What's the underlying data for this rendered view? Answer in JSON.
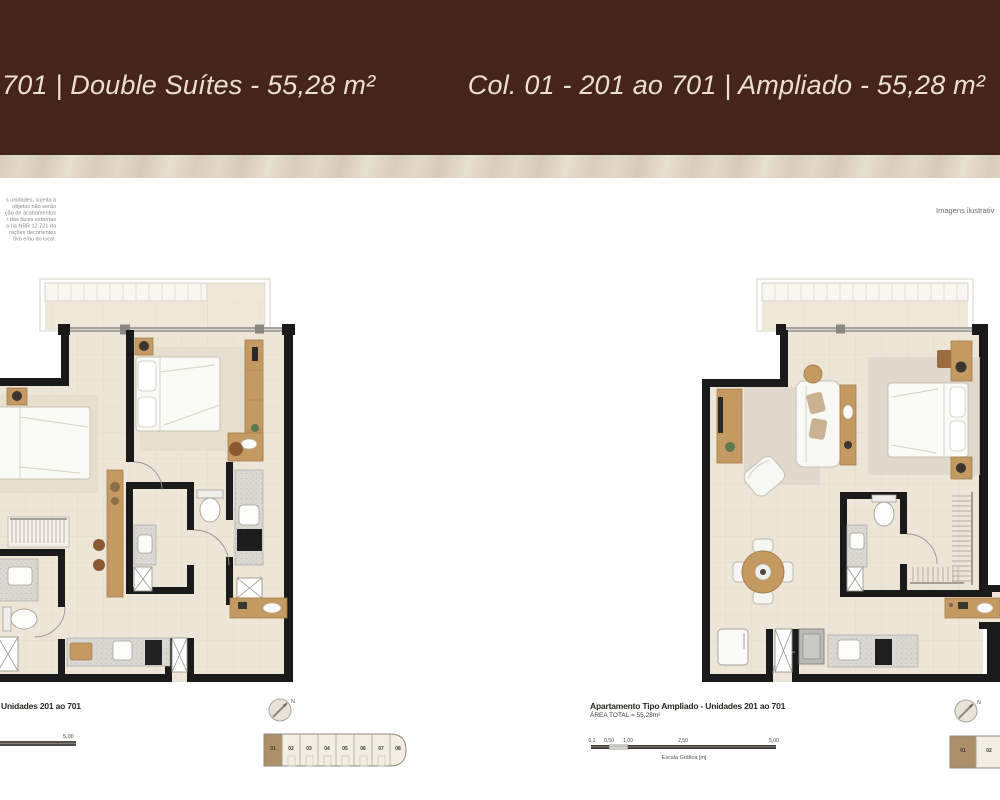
{
  "header": {
    "left_title": "701 | Double Suítes - 55,28 m²",
    "right_title": "Col. 01 - 201 ao 701 | Ampliado - 55,28 m²"
  },
  "annotations": {
    "disclaimer_lines": [
      "s unidades, sujeita à",
      "objetos não serão",
      "ção de acabamentos",
      "r das faces externas",
      "o na NBR 12.721 da",
      "rações decorrentes",
      "tivo e/ou do local."
    ],
    "images_note": "Imagens ilustrativ"
  },
  "left_plan": {
    "caption_title": "Unidades 201 ao 701",
    "scale_label_end": "5,00"
  },
  "right_plan": {
    "caption_title": "Apartamento Tipo Ampliado - Unidades 201 ao 701",
    "caption_area": "ÁREA TOTAL = 55,28m²",
    "scale_labels": [
      "0,1",
      "0,50",
      "1,00",
      "2,50",
      "5,00"
    ],
    "scale_caption": "Escala Gráfica [m]"
  },
  "keyplan": {
    "compass": "N",
    "units": [
      "01",
      "02",
      "03",
      "04",
      "05",
      "06",
      "07",
      "08"
    ],
    "highlighted_unit": "01"
  },
  "colors": {
    "header_bg": "#45251B",
    "header_text": "#EADFD2",
    "strip_bg": "#D8CDBA",
    "wall": "#1A1A1A",
    "floor": "#EDE5D6",
    "wood": "#C49A62",
    "keyplan_highlight": "#AB9069"
  }
}
